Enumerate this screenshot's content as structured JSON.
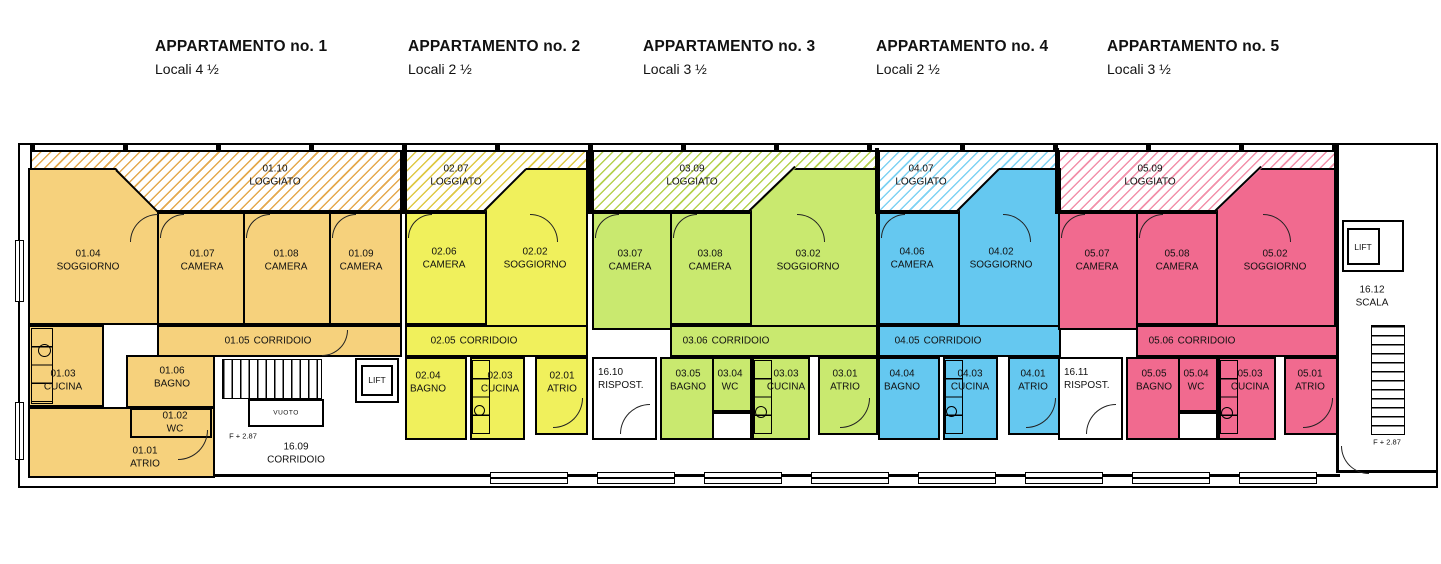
{
  "headers": [
    {
      "title": "APPARTAMENTO no. 1",
      "subtitle": "Locali 4 ½"
    },
    {
      "title": "APPARTAMENTO no. 2",
      "subtitle": "Locali 2 ½"
    },
    {
      "title": "APPARTAMENTO no. 3",
      "subtitle": "Locali 3 ½"
    },
    {
      "title": "APPARTAMENTO no. 4",
      "subtitle": "Locali 2 ½"
    },
    {
      "title": "APPARTAMENTO no. 5",
      "subtitle": "Locali 3 ½"
    }
  ],
  "apartments": [
    {
      "number": 1,
      "fill": "#F6D17C",
      "hatch_color": "#E4A94E",
      "rooms": {
        "loggiato": {
          "id": "01.10",
          "name": "LOGGIATO"
        },
        "soggiorno": {
          "id": "01.04",
          "name": "SOGGIORNO"
        },
        "camera1": {
          "id": "01.07",
          "name": "CAMERA"
        },
        "camera2": {
          "id": "01.08",
          "name": "CAMERA"
        },
        "camera3": {
          "id": "01.09",
          "name": "CAMERA"
        },
        "corridoio": {
          "id": "01.05",
          "name": "CORRIDOIO"
        },
        "cucina": {
          "id": "01.03",
          "name": "CUCINA"
        },
        "bagno": {
          "id": "01.06",
          "name": "BAGNO"
        },
        "wc": {
          "id": "01.02",
          "name": "WC"
        },
        "atrio": {
          "id": "01.01",
          "name": "ATRIO"
        }
      }
    },
    {
      "number": 2,
      "fill": "#F0F05C",
      "hatch_color": "#DFC945",
      "rooms": {
        "loggiato": {
          "id": "02.07",
          "name": "LOGGIATO"
        },
        "camera1": {
          "id": "02.06",
          "name": "CAMERA"
        },
        "soggiorno": {
          "id": "02.02",
          "name": "SOGGIORNO"
        },
        "corridoio": {
          "id": "02.05",
          "name": "CORRIDOIO"
        },
        "bagno": {
          "id": "02.04",
          "name": "BAGNO"
        },
        "cucina": {
          "id": "02.03",
          "name": "CUCINA"
        },
        "atrio": {
          "id": "02.01",
          "name": "ATRIO"
        }
      }
    },
    {
      "number": 3,
      "fill": "#C9E96F",
      "hatch_color": "#B5D14E",
      "rooms": {
        "loggiato": {
          "id": "03.09",
          "name": "LOGGIATO"
        },
        "camera1": {
          "id": "03.07",
          "name": "CAMERA"
        },
        "camera2": {
          "id": "03.08",
          "name": "CAMERA"
        },
        "soggiorno": {
          "id": "03.02",
          "name": "SOGGIORNO"
        },
        "corridoio": {
          "id": "03.06",
          "name": "CORRIDOIO"
        },
        "bagno": {
          "id": "03.05",
          "name": "BAGNO"
        },
        "wc": {
          "id": "03.04",
          "name": "WC"
        },
        "cucina": {
          "id": "03.03",
          "name": "CUCINA"
        },
        "atrio": {
          "id": "03.01",
          "name": "ATRIO"
        }
      }
    },
    {
      "number": 4,
      "fill": "#65C8F0",
      "hatch_color": "#7ED2F3",
      "rooms": {
        "loggiato": {
          "id": "04.07",
          "name": "LOGGIATO"
        },
        "camera1": {
          "id": "04.06",
          "name": "CAMERA"
        },
        "soggiorno": {
          "id": "04.02",
          "name": "SOGGIORNO"
        },
        "corridoio": {
          "id": "04.05",
          "name": "CORRIDOIO"
        },
        "bagno": {
          "id": "04.04",
          "name": "BAGNO"
        },
        "cucina": {
          "id": "04.03",
          "name": "CUCINA"
        },
        "atrio": {
          "id": "04.01",
          "name": "ATRIO"
        }
      }
    },
    {
      "number": 5,
      "fill": "#F16A8F",
      "hatch_color": "#F290AA",
      "rooms": {
        "loggiato": {
          "id": "05.09",
          "name": "LOGGIATO"
        },
        "camera1": {
          "id": "05.07",
          "name": "CAMERA"
        },
        "camera2": {
          "id": "05.08",
          "name": "CAMERA"
        },
        "soggiorno": {
          "id": "05.02",
          "name": "SOGGIORNO"
        },
        "corridoio": {
          "id": "05.06",
          "name": "CORRIDOIO"
        },
        "bagno": {
          "id": "05.05",
          "name": "BAGNO"
        },
        "wc": {
          "id": "05.04",
          "name": "WC"
        },
        "cucina": {
          "id": "05.03",
          "name": "CUCINA"
        },
        "atrio": {
          "id": "05.01",
          "name": "ATRIO"
        }
      }
    }
  ],
  "common": {
    "corridoio": {
      "id": "16.09",
      "name": "CORRIDOIO"
    },
    "ripostiglio_left": {
      "id": "16.10",
      "name": "RISPOST."
    },
    "ripostiglio_right": {
      "id": "16.11",
      "name": "RISPOST."
    },
    "scala": {
      "id": "16.12",
      "name": "SCALA"
    },
    "lift_left": "LIFT",
    "lift_right": "LIFT",
    "vuoto": "VUOTO",
    "level_note_left": "F + 2.87",
    "level_note_right": "F + 2.87"
  }
}
